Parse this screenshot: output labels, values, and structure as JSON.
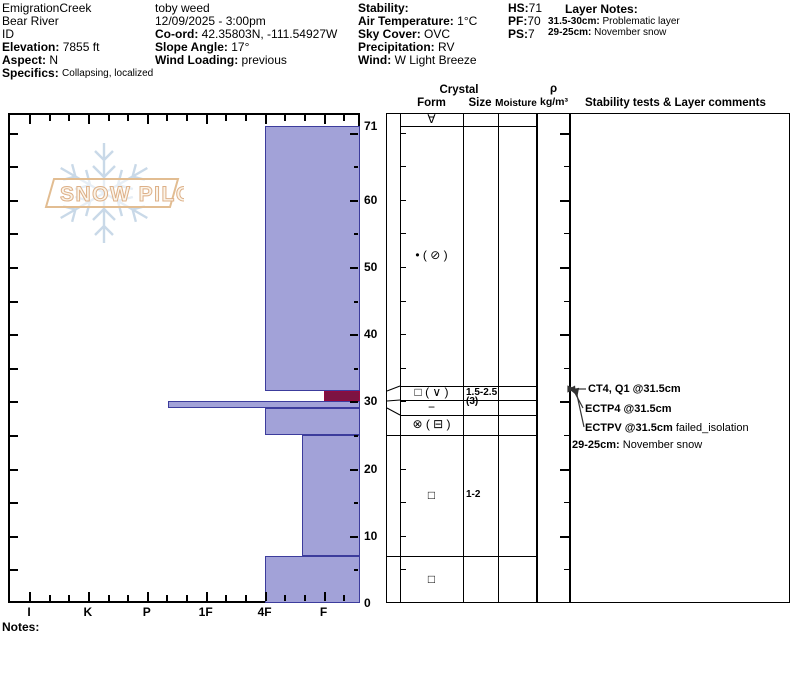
{
  "app": "SnowPilot snow profile graph",
  "logo_text": "SNOW PILOT",
  "header": {
    "col1": {
      "site": "EmigrationCreek",
      "range": "Bear River",
      "state": "ID",
      "elevation_label": "Elevation:",
      "elevation": "7855 ft",
      "aspect_label": "Aspect:",
      "aspect": "N",
      "specifics_label": "Specifics:",
      "specifics": "Collapsing, localized"
    },
    "col2": {
      "observer": "toby weed",
      "datetime": "12/09/2025 - 3:00pm",
      "coord_label": "Co-ord:",
      "coord": "42.35803N, -111.54927W",
      "slope_label": "Slope Angle:",
      "slope": "17°",
      "wind_loading_label": "Wind Loading:",
      "wind_loading": "previous"
    },
    "col3": {
      "stability_label": "Stability:",
      "air_temp_label": "Air Temperature:",
      "air_temp": "1°C",
      "sky_label": "Sky Cover:",
      "sky": "OVC",
      "precip_label": "Precipitation:",
      "precip": "RV",
      "wind_label": "Wind:",
      "wind": "W Light Breeze"
    },
    "col4": {
      "hs_label": "HS:",
      "hs": "71",
      "pf_label": "PF:",
      "pf": "70",
      "ps_label": "PS:",
      "ps": "7"
    },
    "layer_notes": {
      "title": "Layer Notes:",
      "notes": [
        {
          "range": "31.5-30cm:",
          "text": "Problematic layer"
        },
        {
          "range": "29-25cm:",
          "text": "November snow"
        }
      ]
    }
  },
  "chart_data": {
    "type": "bar",
    "title": "Snow hardness profile (depth vs hand hardness)",
    "x_axis": {
      "label": "Hand hardness",
      "categories": [
        "I",
        "K",
        "P",
        "1F",
        "4F",
        "F"
      ]
    },
    "y_axis": {
      "label": "Depth (cm)",
      "max": 71,
      "tick_labels": [
        71,
        60,
        50,
        40,
        30,
        20,
        10,
        0
      ],
      "minor_step": 5
    },
    "layers": [
      {
        "from_cm": 71,
        "to_cm": 31.5,
        "hardness": "4F",
        "hardness_value": 4,
        "flagged": false
      },
      {
        "from_cm": 31.5,
        "to_cm": 30,
        "hardness": "F",
        "hardness_value": 5,
        "flagged": true,
        "note": "Problematic layer"
      },
      {
        "from_cm": 30,
        "to_cm": 29,
        "hardness": "P-",
        "hardness_value": 2.36,
        "flagged": false
      },
      {
        "from_cm": 29,
        "to_cm": 25,
        "hardness": "4F",
        "hardness_value": 4,
        "flagged": false
      },
      {
        "from_cm": 25,
        "to_cm": 7,
        "hardness": "F+",
        "hardness_value": 4.63,
        "flagged": false
      },
      {
        "from_cm": 7,
        "to_cm": 0,
        "hardness": "4F",
        "hardness_value": 4,
        "flagged": false
      }
    ],
    "colors": {
      "layer_fill": "#a2a2d8",
      "layer_border": "#3c3c9c",
      "flagged_fill": "#7d1342",
      "flagged_border": "#95093f"
    }
  },
  "panel": {
    "headers": {
      "crystal": "Crystal",
      "form": "Form",
      "size": "Size",
      "moisture": "Moisture",
      "rho": "ρ",
      "rho_units": "kg/m³",
      "stability": "Stability tests & Layer comments"
    },
    "rows": [
      {
        "band": "surface",
        "form": "∀",
        "size": "",
        "size2": "",
        "moisture": ""
      },
      {
        "band": "71-31.5",
        "form": "• ( ⊘ )",
        "size": "",
        "size2": "",
        "moisture": ""
      },
      {
        "band": "31.5-30",
        "form": "□ ( ∨ )",
        "size": "1.5-2.5",
        "size2": "(3)",
        "moisture": ""
      },
      {
        "band": "30-29",
        "form": "−",
        "size": "",
        "size2": "",
        "moisture": ""
      },
      {
        "band": "29-25",
        "form": "⊗ ( ⊟ )",
        "size": "",
        "size2": "",
        "moisture": ""
      },
      {
        "band": "25-7",
        "form": "□",
        "size": "1-2",
        "size2": "",
        "moisture": ""
      },
      {
        "band": "7-0",
        "form": "□",
        "size": "",
        "size2": "",
        "moisture": ""
      }
    ],
    "stability": {
      "tests": [
        {
          "text": "CT4, Q1 @31.5cm",
          "suffix": ""
        },
        {
          "text": "ECTP4 @31.5cm",
          "suffix": ""
        },
        {
          "text": "ECTPV @31.5cm",
          "suffix": " failed_isolation"
        }
      ],
      "comment": {
        "range": "29-25cm:",
        "text": "November snow"
      }
    }
  },
  "footer": {
    "notes_label": "Notes:"
  }
}
